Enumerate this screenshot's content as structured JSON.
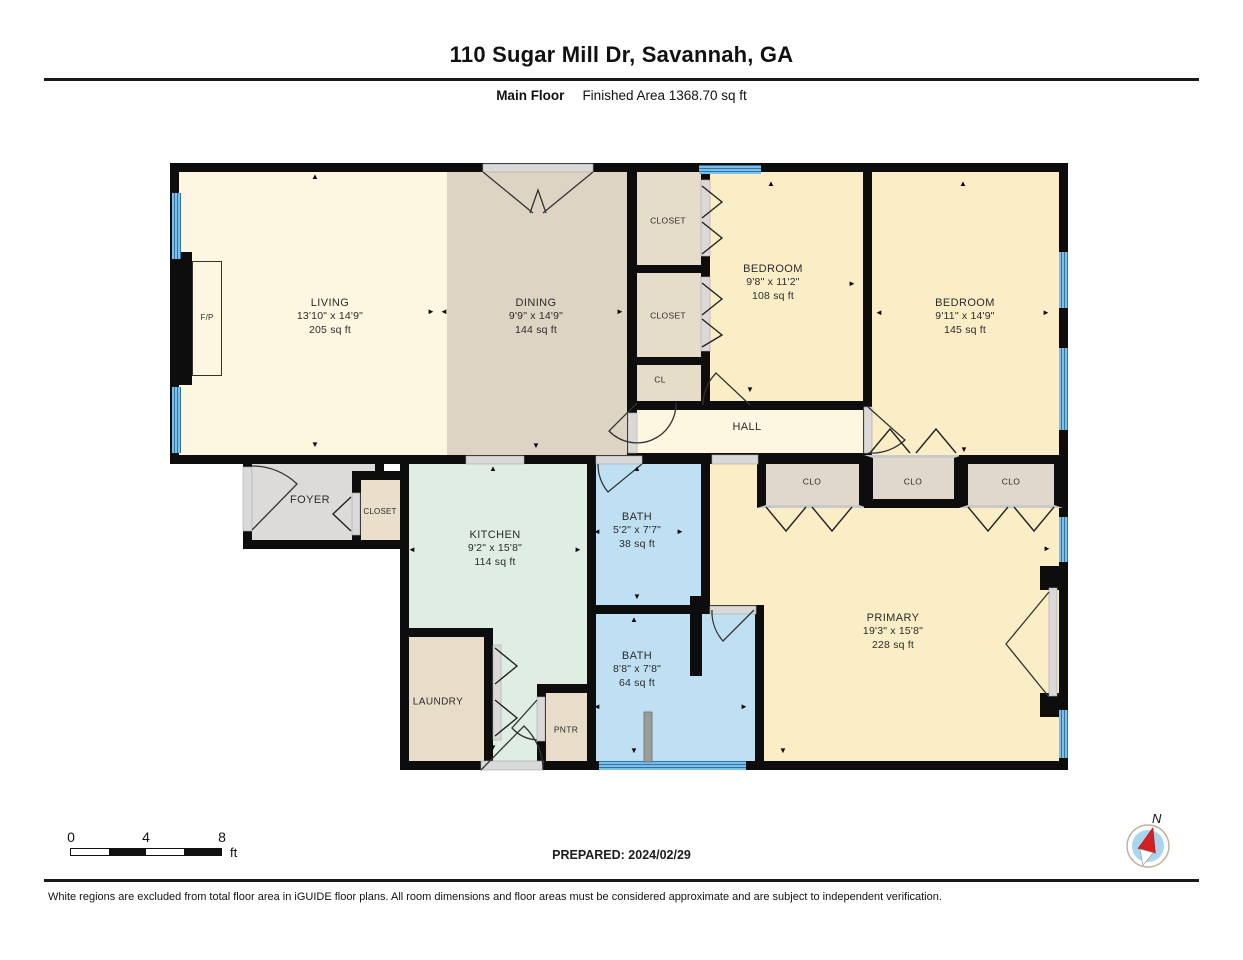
{
  "header": {
    "title": "110 Sugar Mill Dr, Savannah, GA",
    "floor_label": "Main Floor",
    "area_label": "Finished Area 1368.70 sq ft"
  },
  "rooms": {
    "living": {
      "name": "LIVING",
      "dims": "13'10\" x 14'9\"",
      "area": "205 sq ft"
    },
    "dining": {
      "name": "DINING",
      "dims": "9'9\" x 14'9\"",
      "area": "144 sq ft"
    },
    "bedroom1": {
      "name": "BEDROOM",
      "dims": "9'8\" x 11'2\"",
      "area": "108 sq ft"
    },
    "bedroom2": {
      "name": "BEDROOM",
      "dims": "9'11\" x 14'9\"",
      "area": "145 sq ft"
    },
    "kitchen": {
      "name": "KITCHEN",
      "dims": "9'2\" x 15'8\"",
      "area": "114 sq ft"
    },
    "bath1": {
      "name": "BATH",
      "dims": "5'2\" x 7'7\"",
      "area": "38 sq ft"
    },
    "bath2": {
      "name": "BATH",
      "dims": "8'8\" x 7'8\"",
      "area": "64 sq ft"
    },
    "primary": {
      "name": "PRIMARY",
      "dims": "19'3\" x 15'8\"",
      "area": "228 sq ft"
    },
    "hall": {
      "name": "HALL"
    },
    "foyer": {
      "name": "FOYER"
    },
    "laundry": {
      "name": "LAUNDRY"
    },
    "pantry": {
      "name": "PNTR"
    },
    "foyer_closet": {
      "name": "CLOSET"
    },
    "closet_a": {
      "name": "CLOSET"
    },
    "closet_b": {
      "name": "CLOSET"
    },
    "cl": {
      "name": "CL"
    },
    "clo1": {
      "name": "CLO"
    },
    "clo2": {
      "name": "CLO"
    },
    "clo3": {
      "name": "CLO"
    },
    "fireplace": {
      "name": "F/P"
    }
  },
  "icons": {
    "arrow_up": "▲",
    "arrow_down": "▼",
    "arrow_left": "◄",
    "arrow_right": "►"
  },
  "scale_bar": {
    "tick0": "0",
    "tick1": "4",
    "tick2": "8",
    "unit": "ft"
  },
  "prepared": "PREPARED: 2024/02/29",
  "compass": {
    "label": "N"
  },
  "footer": "White regions are excluded from total floor area in iGUIDE floor plans. All room dimensions and floor areas must be considered approximate and are subject to independent verification.",
  "colors": {
    "wall": "#0d0d0d",
    "window_blue": "#4f9fd0",
    "living_cream": "#fdf6e0",
    "dining_tan": "#ddd4c3",
    "bedroom_yellow": "#fbedc6",
    "kitchen_mint": "#dfede3",
    "bath_blue": "#bfe0f2",
    "foyer_gray": "#dcdbd9",
    "closet_tan": "#e7decb",
    "compass_red": "#d42020",
    "compass_blue": "#a9d6ef"
  }
}
